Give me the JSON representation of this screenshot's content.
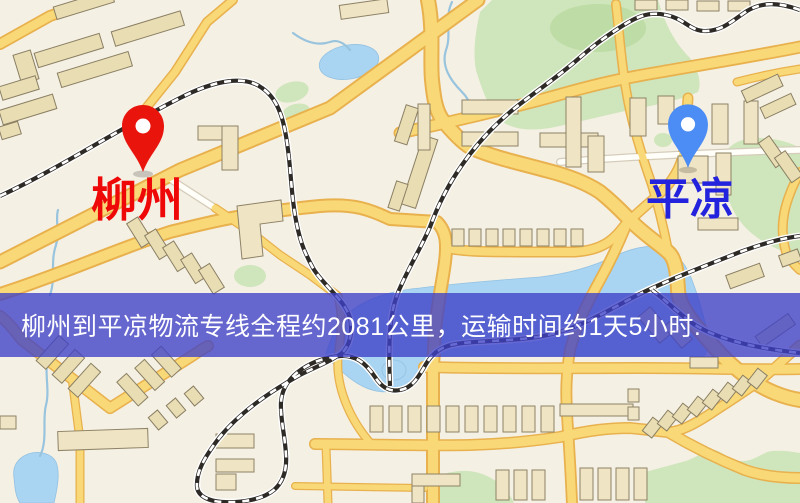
{
  "map": {
    "origin_marker": {
      "label": "柳州",
      "pin_color": "#e9150d",
      "label_color": "#ee0808"
    },
    "destination_marker": {
      "label": "平凉",
      "pin_color": "#4b8cf5",
      "label_color": "#2323dd"
    },
    "banner": {
      "text": "柳州到平凉物流专线全程约2081公里，运输时间约1天5小时.",
      "background_color": "rgba(62,64,200,0.78)",
      "text_color": "#ffffff"
    },
    "route_info": {
      "from": "柳州",
      "to": "平凉",
      "service": "物流专线",
      "distance_text": "全程约2081公里",
      "duration_text": "运输时间约1天5小时"
    },
    "palette": {
      "background": "#f5f0e4",
      "road_fill": "#f9d977",
      "road_casing": "#e8b14e",
      "railway": "#2e2a26",
      "water": "#a9d4f2",
      "park": "#cfe5bb",
      "building": "#efe5c4"
    }
  }
}
